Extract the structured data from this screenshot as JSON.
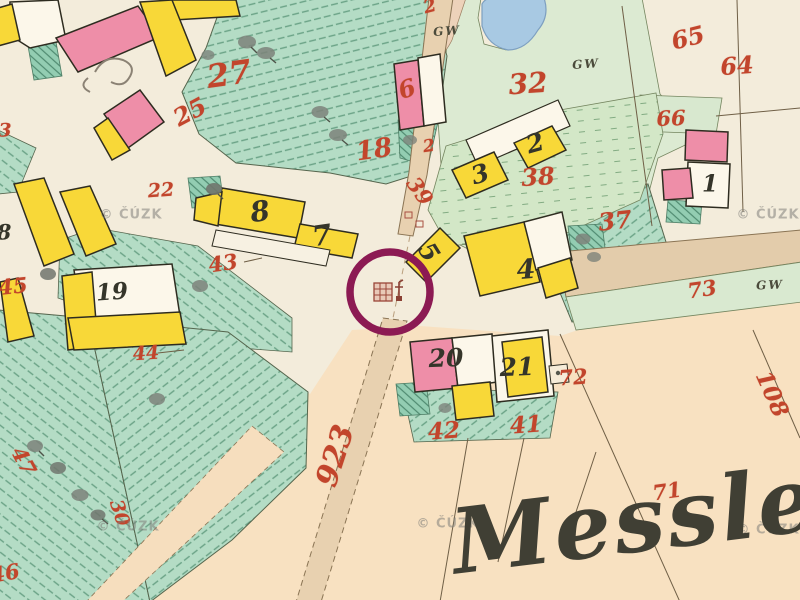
{
  "map": {
    "type": "historical cadastral map sheet",
    "place_name": "Messler",
    "copyright_watermark": "© ČÚZK",
    "highlight": {
      "shape": "circle",
      "color": "#8c1a53",
      "cx": 390,
      "cy": 292,
      "r": 40,
      "target": "chapel-symbol"
    },
    "legend_colors": {
      "yellow_building": "#f8d838",
      "masonry_building_pink": "#ee8ea8",
      "garden_green": "#b4dcc5",
      "meadow_green": "#d3e7c7",
      "road_tan": "#e8d1b0",
      "water_blue": "#a8c9e3",
      "parcel_number_red": "#c2452c",
      "ink_black": "#35352a"
    }
  },
  "labels": [
    {
      "name": "parcel-25",
      "kind": "parcel",
      "text": "25",
      "x": 190,
      "y": 112,
      "size": 24,
      "rot": -28
    },
    {
      "name": "parcel-27",
      "kind": "parcel",
      "text": "27",
      "x": 229,
      "y": 74,
      "size": 32,
      "rot": -8
    },
    {
      "name": "parcel-6",
      "kind": "parcel",
      "text": "6",
      "x": 407,
      "y": 89,
      "size": 24,
      "rot": -18
    },
    {
      "name": "parcel-18",
      "kind": "parcel",
      "text": "18",
      "x": 374,
      "y": 150,
      "size": 26,
      "rot": -8
    },
    {
      "name": "parcel-2-small",
      "kind": "parcel",
      "text": "2",
      "x": 429,
      "y": 147,
      "size": 17,
      "rot": -8
    },
    {
      "name": "parcel-2-top",
      "kind": "parcel",
      "text": "2",
      "x": 430,
      "y": 7,
      "size": 18,
      "rot": -15
    },
    {
      "name": "parcel-32",
      "kind": "parcel",
      "text": "32",
      "x": 528,
      "y": 84,
      "size": 28,
      "rot": -4
    },
    {
      "name": "parcel-65",
      "kind": "parcel",
      "text": "65",
      "x": 688,
      "y": 38,
      "size": 24,
      "rot": -14
    },
    {
      "name": "parcel-64",
      "kind": "parcel",
      "text": "64",
      "x": 737,
      "y": 66,
      "size": 24,
      "rot": -4
    },
    {
      "name": "parcel-66",
      "kind": "parcel",
      "text": "66",
      "x": 671,
      "y": 118,
      "size": 21,
      "rot": -2
    },
    {
      "name": "parcel-39",
      "kind": "parcel",
      "text": "39",
      "x": 420,
      "y": 191,
      "size": 21,
      "rot": 55
    },
    {
      "name": "parcel-38",
      "kind": "parcel",
      "text": "38",
      "x": 538,
      "y": 177,
      "size": 24,
      "rot": -4
    },
    {
      "name": "parcel-37",
      "kind": "parcel",
      "text": "37",
      "x": 615,
      "y": 221,
      "size": 24,
      "rot": -6
    },
    {
      "name": "parcel-73",
      "kind": "parcel",
      "text": "73",
      "x": 702,
      "y": 289,
      "size": 21,
      "rot": -8
    },
    {
      "name": "parcel-72",
      "kind": "parcel",
      "text": "72",
      "x": 573,
      "y": 377,
      "size": 21,
      "rot": -4
    },
    {
      "name": "parcel-108",
      "kind": "parcel",
      "text": "108",
      "x": 772,
      "y": 394,
      "size": 23,
      "rot": 66
    },
    {
      "name": "parcel-22",
      "kind": "parcel",
      "text": "22",
      "x": 161,
      "y": 191,
      "size": 19,
      "rot": -4
    },
    {
      "name": "parcel-43",
      "kind": "parcel",
      "text": "43",
      "x": 223,
      "y": 263,
      "size": 21,
      "rot": -8
    },
    {
      "name": "parcel-45",
      "kind": "parcel",
      "text": "45",
      "x": 13,
      "y": 286,
      "size": 21,
      "rot": -6
    },
    {
      "name": "parcel-44",
      "kind": "parcel",
      "text": "44",
      "x": 146,
      "y": 354,
      "size": 19,
      "rot": -4
    },
    {
      "name": "parcel-47",
      "kind": "parcel",
      "text": "47",
      "x": 24,
      "y": 461,
      "size": 21,
      "rot": 62
    },
    {
      "name": "parcel-30",
      "kind": "parcel",
      "text": "30",
      "x": 119,
      "y": 513,
      "size": 19,
      "rot": 72
    },
    {
      "name": "parcel-42",
      "kind": "parcel",
      "text": "42",
      "x": 444,
      "y": 431,
      "size": 23,
      "rot": -4
    },
    {
      "name": "parcel-41",
      "kind": "parcel",
      "text": "41",
      "x": 526,
      "y": 425,
      "size": 23,
      "rot": -4
    },
    {
      "name": "parcel-71",
      "kind": "parcel",
      "text": "71",
      "x": 667,
      "y": 491,
      "size": 21,
      "rot": -8
    },
    {
      "name": "parcel-46",
      "kind": "parcel",
      "text": "46",
      "x": 5,
      "y": 573,
      "size": 21,
      "rot": -10
    },
    {
      "name": "parcel-3-edge",
      "kind": "parcel",
      "text": "3",
      "x": 5,
      "y": 131,
      "size": 19,
      "rot": 0
    },
    {
      "name": "road-number-923",
      "kind": "road",
      "text": "923",
      "x": 336,
      "y": 456,
      "size": 30,
      "rot": -72
    },
    {
      "name": "house-1",
      "kind": "building",
      "text": "1",
      "x": 710,
      "y": 184,
      "size": 23,
      "rot": 0
    },
    {
      "name": "house-8",
      "kind": "building",
      "text": "8",
      "x": 260,
      "y": 212,
      "size": 28,
      "rot": -8
    },
    {
      "name": "house-7",
      "kind": "building",
      "text": "7",
      "x": 322,
      "y": 236,
      "size": 28,
      "rot": -8
    },
    {
      "name": "house-19",
      "kind": "building",
      "text": "19",
      "x": 112,
      "y": 292,
      "size": 23,
      "rot": -4
    },
    {
      "name": "house-3",
      "kind": "building",
      "text": "3",
      "x": 480,
      "y": 174,
      "size": 25,
      "rot": -16
    },
    {
      "name": "house-2",
      "kind": "building",
      "text": "2",
      "x": 535,
      "y": 143,
      "size": 25,
      "rot": -16
    },
    {
      "name": "house-5",
      "kind": "building",
      "text": "5",
      "x": 429,
      "y": 252,
      "size": 25,
      "rot": 58
    },
    {
      "name": "house-4",
      "kind": "building",
      "text": "4",
      "x": 526,
      "y": 270,
      "size": 27,
      "rot": -4
    },
    {
      "name": "house-20",
      "kind": "building",
      "text": "20",
      "x": 446,
      "y": 358,
      "size": 25,
      "rot": -2
    },
    {
      "name": "house-21",
      "kind": "building",
      "text": "21",
      "x": 517,
      "y": 367,
      "size": 25,
      "rot": -2
    },
    {
      "name": "house-8-edge",
      "kind": "building",
      "text": "8",
      "x": 4,
      "y": 232,
      "size": 21,
      "rot": 0
    },
    {
      "name": "gw-label-1",
      "kind": "gw",
      "text": "GW",
      "x": 447,
      "y": 31,
      "size": 12,
      "rot": -4
    },
    {
      "name": "gw-label-2",
      "kind": "gw",
      "text": "GW",
      "x": 586,
      "y": 64,
      "size": 12,
      "rot": -4
    },
    {
      "name": "gw-label-3",
      "kind": "gw",
      "text": "GW",
      "x": 770,
      "y": 285,
      "size": 12,
      "rot": -2
    },
    {
      "name": "watermark-1",
      "kind": "watermark",
      "text": "© ČÚZK",
      "x": 131,
      "y": 215,
      "size": 13,
      "rot": 0
    },
    {
      "name": "watermark-2",
      "kind": "watermark",
      "text": "© ČÚZK",
      "x": 768,
      "y": 215,
      "size": 13,
      "rot": 0
    },
    {
      "name": "watermark-3",
      "kind": "watermark",
      "text": "© ČÚZK",
      "x": 448,
      "y": 524,
      "size": 13,
      "rot": 0
    },
    {
      "name": "watermark-4",
      "kind": "watermark",
      "text": "© ČÚZK",
      "x": 128,
      "y": 527,
      "size": 13,
      "rot": 0
    },
    {
      "name": "watermark-5",
      "kind": "watermark",
      "text": "© ČÚZK",
      "x": 768,
      "y": 530,
      "size": 13,
      "rot": 0
    },
    {
      "name": "place-name",
      "kind": "place",
      "text": "Messler",
      "x": 452,
      "y": 543,
      "size": 90,
      "rot": -7,
      "anchor": "left"
    }
  ]
}
